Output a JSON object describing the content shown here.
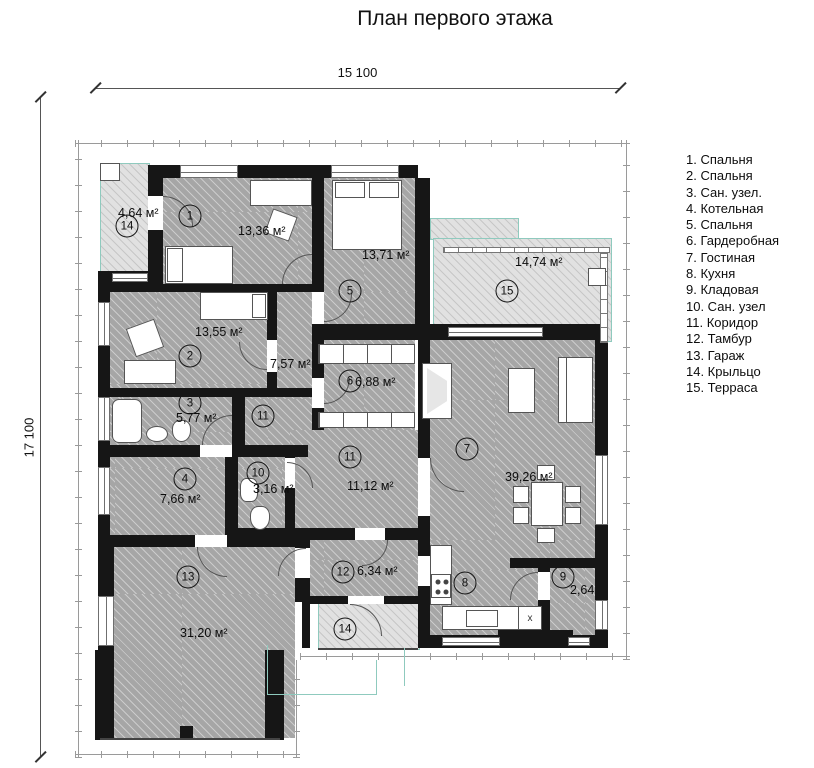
{
  "title": "План первого этажа",
  "dimensions": {
    "top": "15 100",
    "left": "17 100"
  },
  "legend": {
    "items": [
      "1. Спальня",
      "2. Спальня",
      "3. Сан. узел.",
      "4. Котельная",
      "5. Спальня",
      "6. Гардеробная",
      "7. Гостиная",
      "8. Кухня",
      "9. Кладовая",
      "10. Сан. узел",
      "11. Коридор",
      "12. Тамбур",
      "13. Гараж",
      "14. Крыльцо",
      "15. Терраса"
    ]
  },
  "rooms": {
    "r1": {
      "num": "1",
      "area": "13,36 м²"
    },
    "r2": {
      "num": "2",
      "area": "13,55 м²"
    },
    "r3": {
      "num": "3",
      "area": "5,77 м²"
    },
    "r4": {
      "num": "4",
      "area": "7,66 м²"
    },
    "r5": {
      "num": "5",
      "area": "13,71 м²"
    },
    "r6": {
      "num": "6",
      "area": "6,88 м²"
    },
    "r7": {
      "num": "7",
      "area": "39,26 м²"
    },
    "r8": {
      "num": "8"
    },
    "r9": {
      "num": "9",
      "area": "2,64"
    },
    "r10": {
      "num": "10",
      "area": "3,16 м²"
    },
    "r11a": {
      "num": "11",
      "area": "7,57 м²"
    },
    "r11b": {
      "num": "11",
      "area": "11,12 м²"
    },
    "r12": {
      "num": "12",
      "area": "6,34 м²"
    },
    "r13": {
      "num": "13",
      "area": "31,20 м²"
    },
    "r14a": {
      "num": "14",
      "area": "4,64 м²"
    },
    "r14b": {
      "num": "14"
    },
    "r15": {
      "num": "15",
      "area": "14,74 м²"
    }
  },
  "kitchen_marker": "x",
  "colors": {
    "wall": "#161616",
    "room_fill": "#a6a6a6",
    "outdoor_fill": "#e1e1e1",
    "outdoor_outline": "#8fcabe"
  }
}
